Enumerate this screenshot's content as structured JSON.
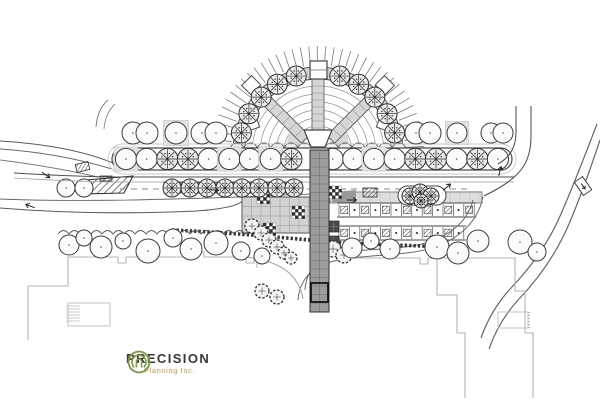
{
  "document": {
    "type": "landscape-site-plan",
    "background": "#ffffff"
  },
  "logo": {
    "name": "PRECISION",
    "tagline": "Planning Inc.",
    "icon": "concentric-rings-icon",
    "colors": {
      "icon": "#7e9c4d",
      "name": "#3c3935",
      "tagline": "#c8964f"
    }
  },
  "drawing": {
    "palette": {
      "line": "#4a4a4a",
      "line_soft": "#8f8f8f",
      "line_faint": "#b5b5b5",
      "fill_light": "#e6e6e6",
      "fill_mid": "#d6d6d6",
      "fill_gray": "#9c9c9c",
      "fill_dark": "#4a4a4a",
      "ink": "#2e2e2e"
    },
    "fan": {
      "cx": 318,
      "cy": 152,
      "tick_r1": 87,
      "tick_r2": 106,
      "tick_step_deg": 4.6,
      "band_r_inner": 73,
      "band_r_outer": 85,
      "arc_radii": [
        18,
        26,
        34,
        42,
        50,
        58,
        66
      ],
      "spoke_angles_deg": [
        45,
        135
      ],
      "side_caps": [
        [
          251.7,
          124,
          -20
        ],
        [
          384.3,
          124,
          20
        ]
      ],
      "tree_angles_deg": [
        14,
        29,
        44,
        59,
        74,
        106,
        121,
        136,
        151,
        166
      ],
      "tree_radius_pos": 79,
      "tree_r": 10,
      "hedge_y": 150,
      "hedge_r": 7,
      "hedge_x1": 237,
      "hedge_x2": 401,
      "hedge_step": 13.5
    },
    "allee": {
      "x1": 112,
      "x2": 512,
      "cy": 159,
      "half_h": 11,
      "tree_count": 19,
      "tree_r": 10.6,
      "skip_indices": [
        9
      ],
      "hatched_indices": [
        2,
        3,
        8,
        14,
        15,
        17
      ],
      "grate_indices": [
        0,
        5,
        7,
        12
      ]
    },
    "upper_trees": [
      [
        133,
        133,
        11,
        "plain"
      ],
      [
        147,
        133,
        11,
        "plain"
      ],
      [
        176,
        133,
        11,
        "grate"
      ],
      [
        202,
        133,
        11,
        "plain"
      ],
      [
        216,
        133,
        11,
        "plain"
      ],
      [
        416,
        133,
        11,
        "plain"
      ],
      [
        430,
        133,
        11,
        "plain"
      ],
      [
        457,
        133,
        10,
        "grate"
      ],
      [
        491,
        133,
        10,
        "plain"
      ],
      [
        503,
        133,
        10,
        "plain"
      ]
    ],
    "median_trees": [
      [
        66,
        188,
        9
      ],
      [
        84,
        188,
        9
      ]
    ],
    "row_trees": {
      "y": 188,
      "r": 9,
      "xs": [
        172,
        190,
        207,
        225,
        242,
        259,
        277,
        294
      ],
      "strip": [
        164,
        182,
        138,
        11
      ]
    },
    "scattered_trees": [
      [
        69,
        245,
        10
      ],
      [
        84,
        238,
        8
      ],
      [
        101,
        247,
        11
      ],
      [
        123,
        241,
        8
      ],
      [
        148,
        251,
        12
      ],
      [
        173,
        238,
        9
      ],
      [
        191,
        249,
        11
      ],
      [
        216,
        243,
        12
      ],
      [
        241,
        251,
        9
      ],
      [
        262,
        256,
        8
      ],
      [
        352,
        248,
        10
      ],
      [
        371,
        241,
        8
      ],
      [
        390,
        249,
        10
      ],
      [
        437,
        247,
        12
      ],
      [
        458,
        253,
        11
      ],
      [
        478,
        241,
        11
      ],
      [
        520,
        242,
        12
      ],
      [
        537,
        252,
        9
      ]
    ],
    "shrub_chain": [
      [
        252,
        226,
        7
      ],
      [
        261,
        233,
        7
      ],
      [
        269,
        240,
        7
      ],
      [
        277,
        247,
        7
      ],
      [
        284,
        253,
        6
      ],
      [
        291,
        258,
        6
      ],
      [
        262,
        291,
        7
      ],
      [
        277,
        297,
        7
      ],
      [
        333,
        249,
        8
      ],
      [
        344,
        255,
        8
      ]
    ],
    "island_shrubs": [
      [
        410,
        196,
        8
      ],
      [
        420,
        192,
        8
      ],
      [
        431,
        196,
        8
      ],
      [
        421,
        201,
        7
      ]
    ],
    "promenade": {
      "x": 310,
      "w": 19,
      "y1": 150,
      "y2": 312,
      "cell": 8.5,
      "frame": [
        311,
        283,
        17,
        19
      ],
      "spoke": [
        312,
        79,
        12,
        51
      ],
      "cap": [
        310,
        61,
        17,
        18
      ],
      "wedge": "304,130 332,130 325,147 311,147"
    },
    "plaza_grid": {
      "x": 242,
      "y": 197,
      "w": 68,
      "h": 36,
      "cell": 9.5
    },
    "aisle_strip": {
      "x": 330,
      "y": 192,
      "w": 152,
      "h": 11,
      "cell": 10
    },
    "parking": {
      "x0": 339,
      "stall_w": 10.4,
      "rows": [
        {
          "y": 203,
          "h": 14,
          "n": 13
        },
        {
          "y": 226,
          "h": 14,
          "n": 12
        }
      ]
    },
    "checkers": [
      [
        257,
        191
      ],
      [
        292,
        206
      ],
      [
        329,
        186
      ],
      [
        263,
        223
      ]
    ],
    "checker_cell": 3.2,
    "dark_tiles": [
      [
        328,
        221
      ],
      [
        328,
        236
      ]
    ],
    "crosswalks": [
      [
        76,
        163,
        13,
        8,
        -14
      ],
      [
        363,
        188,
        14,
        9,
        0
      ],
      [
        100,
        176,
        12,
        5,
        0
      ]
    ],
    "arrows": [
      [
        46,
        175,
        35
      ],
      [
        30,
        206,
        200
      ],
      [
        214,
        190,
        5
      ],
      [
        352,
        200,
        0
      ],
      [
        500,
        171,
        285
      ],
      [
        447,
        187,
        320
      ]
    ],
    "wavy_hedge": {
      "x1": 58,
      "x2": 246,
      "y": 234,
      "step": 11,
      "bump": 7
    }
  }
}
